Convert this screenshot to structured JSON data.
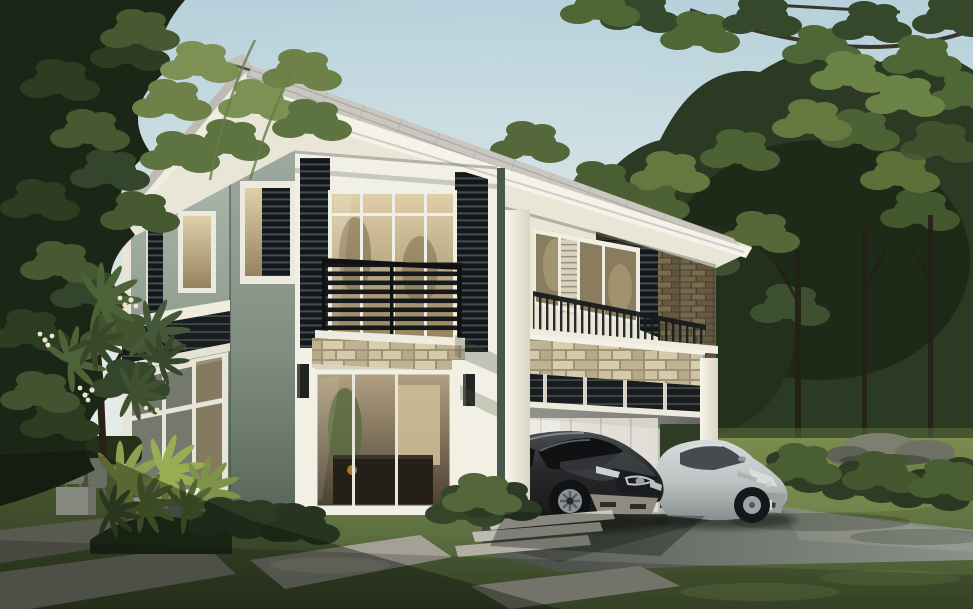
{
  "scene": {
    "domain": "natural-image",
    "subject": "Photorealistic exterior rendering of a modern two-storey house with carport, two parked cars, lawn, stone walkway and surrounding trees",
    "notable_objects": [
      "hip roof with grey shingles and deep white eaves",
      "sage green rendered walls with white trim",
      "black aluminium slat screens and balcony railings",
      "stacked-stone accent bands",
      "glass sliding doors with warm interior",
      "double carport with dark grey hatchback and silver sedan",
      "concrete driveway and stepping-stone walkway",
      "frangipani tree with white flowers",
      "dense background woodland and overhanging branches"
    ]
  },
  "palette": {
    "sky_top": "#b6d1db",
    "sky_horizon": "#edf0ea",
    "foliage_dark": "#1c2616",
    "foliage_mid": "#33452a",
    "foliage_light": "#64793f",
    "foliage_bright": "#7e9154",
    "roof_shingle": "#c9c7c0",
    "fascia_white": "#f5f3e9",
    "soffit_cream": "#e9e6d8",
    "wall_sage_light": "#adb9ae",
    "wall_sage_dark": "#5f6f60",
    "trim_white": "#f2f0e5",
    "slat_dark": "#14181b",
    "stone_tan": "#cdc2a4",
    "stone_brown": "#6e624c",
    "glass_warm": "#d8c8a2",
    "glass_shade": "#8a7c5e",
    "interior_warm": "#a8977a",
    "lawn_back": "#7b8c4f",
    "lawn_front": "#3f4d2c",
    "driveway_light": "#8b9087",
    "driveway_dark": "#565c55",
    "paver_light": "#a3a196",
    "car_dark": "#26282a",
    "car_silver": "#c0c4c4"
  }
}
